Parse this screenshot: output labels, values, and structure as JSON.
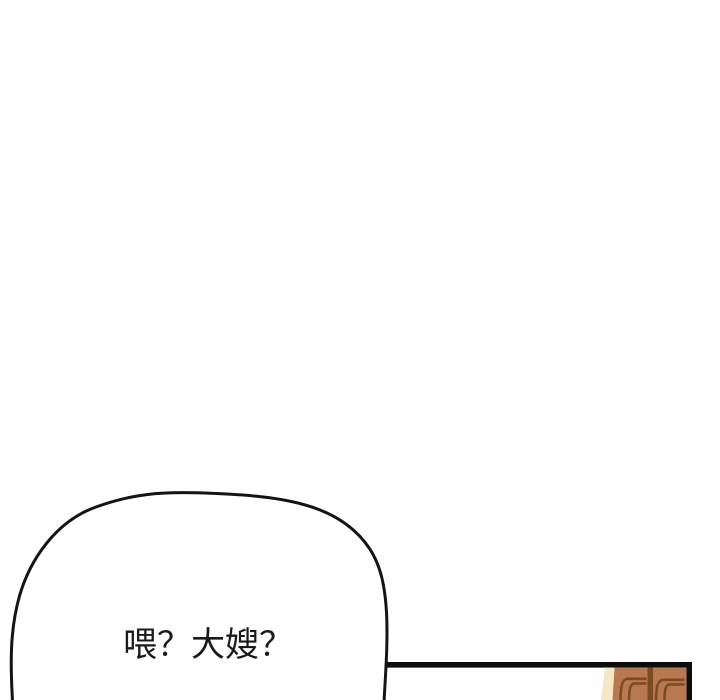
{
  "page": {
    "background": "#ffffff"
  },
  "speech_bubble": {
    "text": "喂？大嫂？",
    "text_color": "#1a1a1a",
    "fill": "#ffffff",
    "stroke": "#141414"
  },
  "next_panel": {
    "border_color": "#0d0d0d",
    "artwork": {
      "skin_light": "#f7e6c8",
      "skin_mid": "#b97950",
      "outline": "#7d4a28"
    }
  }
}
